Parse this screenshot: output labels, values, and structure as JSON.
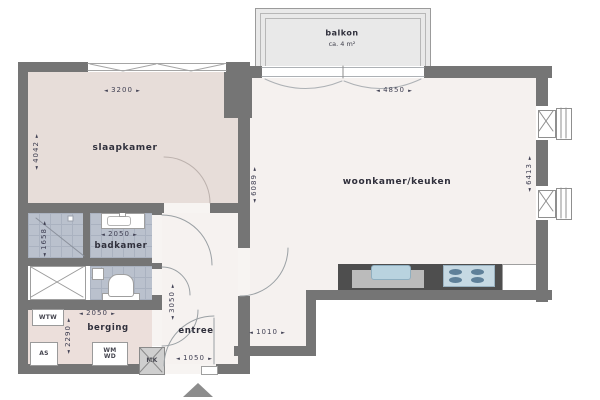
{
  "ui": {
    "arrow_left": "◄",
    "arrow_right": "►"
  },
  "balcony": {
    "label": "balkon",
    "area": "ca. 4 m²"
  },
  "rooms": {
    "slaapkamer": "slaapkamer",
    "woonkamer": "woonkamer/keuken",
    "badkamer": "badkamer",
    "berging": "berging",
    "entree": "entree"
  },
  "closets": {
    "wtw": "WTW",
    "as": "AS",
    "wm": "WM",
    "wd": "WD",
    "mk": "MK"
  },
  "dims": {
    "slaapkamer_width": "3200",
    "woonkamer_width": "4850",
    "slaapkamer_depth": "4042",
    "woonkamer_depth": "6089",
    "facade_right": "6413",
    "badkamer_width": "2050",
    "shower_depth": "1658",
    "berging_width": "2050",
    "berging_depth": "2290",
    "entree_depth": "3050",
    "entrance_width": "1050",
    "passage_width": "1010"
  },
  "colors": {
    "wall": "#757575",
    "tile": "#bac1cd",
    "slaapkamer_floor": "#e7ddd9",
    "woonkamer_floor": "#f5f1ef",
    "berging_floor": "#ecdfdb",
    "balcony": "#e9e9e9",
    "counter": "#4e4e4e",
    "appliance_blue": "#bcd4e0"
  }
}
